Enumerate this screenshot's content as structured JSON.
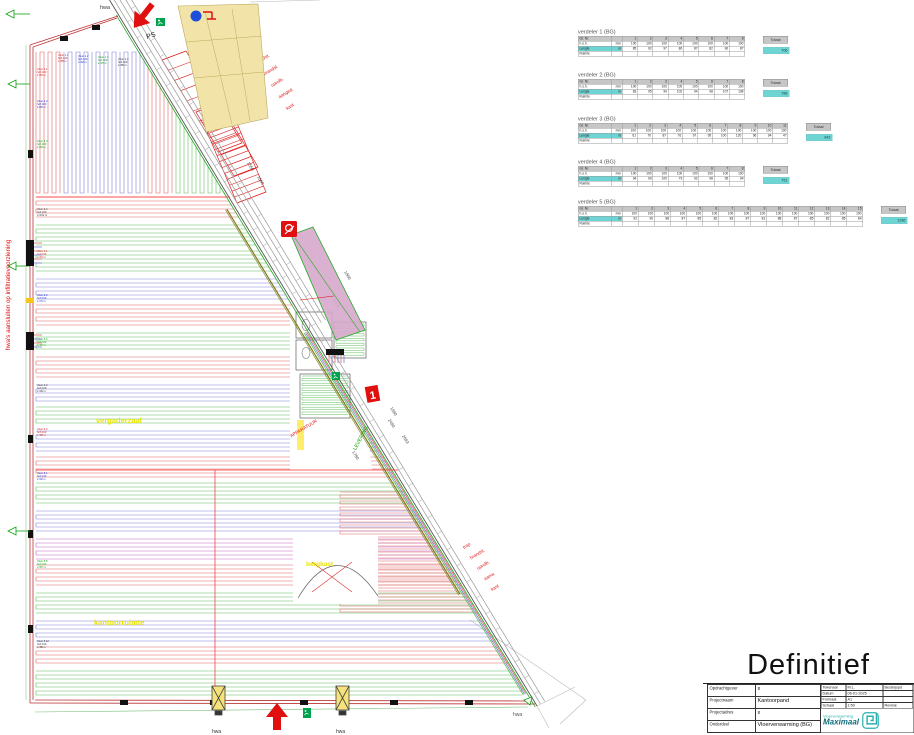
{
  "status_title": "Definitief",
  "plan": {
    "note_left": "hwa's aansluiten op infiltratievoorziening",
    "hwa": "hwa",
    "ps": "PS",
    "unit_one": "1",
    "rooms": {
      "vergaderzaal": "vergaderzaal",
      "kantoorruimte": "kantoorruimte",
      "bergkast": "bergkast",
      "apparatuur": "APPARATUUR",
      "levering": "LEVERING"
    },
    "stack_top": [
      "Vluchtr.",
      "brandsl.",
      "oprolb.",
      "aanged.",
      "kast"
    ],
    "stack_bottom": [
      "trap",
      "brandsl.",
      "oprolb.",
      "aanw.",
      "kast"
    ],
    "dims": [
      "1550",
      "1500",
      "2100",
      "1800",
      "1990",
      "2693",
      "2490",
      "1780"
    ],
    "group_labels": [
      [
        "Vloer 1.1",
        "hoh 100",
        "L=85 m"
      ],
      [
        "Vloer 1.2",
        "hoh 100",
        "L=92 m"
      ],
      [
        "Vloer 1.3",
        "hoh 100",
        "L=97 m"
      ],
      [
        "Vloer 1.4",
        "hoh 100",
        "L=86 m"
      ],
      [
        "Vloer 2.1",
        "hoh 100",
        "L=83 m"
      ],
      [
        "Vloer 2.2",
        "hoh 100",
        "L=95 m"
      ],
      [
        "Vloer 2.3",
        "hoh 100",
        "L=99 m"
      ],
      [
        "Vloer 2.4",
        "hoh 100",
        "L=102 m"
      ],
      [
        "Vloer 3.1",
        "hoh 100",
        "L=61 m"
      ],
      [
        "Vloer 3.2",
        "hoh 100",
        "L=70 m"
      ],
      [
        "Vloer 3.5",
        "hoh 100",
        "L=97 m"
      ],
      [
        "Vloer 4.2",
        "hoh 100",
        "L=99 m"
      ],
      [
        "Vloer 4.6",
        "hoh 100",
        "L=98 m"
      ],
      [
        "Vloer 5.1",
        "hoh 100",
        "L=92 m"
      ],
      [
        "Vloer 5.8",
        "hoh 100",
        "L=87 m"
      ],
      [
        "Vloer 5.12",
        "hoh 100",
        "L=85 m"
      ]
    ]
  },
  "verdeler_table": {
    "row_group": "Gr. Nr.",
    "row_hoh": "h.o.h.",
    "row_len": "Lengte",
    "row_room": "Ruimte",
    "unit_mm": "mm",
    "unit_m": "m",
    "total_label": "Totaal"
  },
  "verdelers": [
    {
      "title": "verdeler 1 (BG)",
      "hoh": "100",
      "lengths": [
        "85",
        "92",
        "97",
        "86",
        "87",
        "82",
        "90",
        "87"
      ],
      "total": "706"
    },
    {
      "title": "verdeler 2 (BG)",
      "hoh": "100",
      "lengths": [
        "83",
        "95",
        "99",
        "102",
        "94",
        "98",
        "107",
        "108"
      ],
      "total": "786"
    },
    {
      "title": "verdeler 3 (BG)",
      "hoh": "100",
      "lengths": [
        "61",
        "70",
        "87",
        "76",
        "97",
        "95",
        "100",
        "120",
        "96",
        "94",
        "47"
      ],
      "total": "943"
    },
    {
      "title": "verdeler 4 (BG)",
      "hoh": "100",
      "lengths": [
        "94",
        "99",
        "100",
        "79",
        "92",
        "98",
        "95",
        "94"
      ],
      "total": "751"
    },
    {
      "title": "verdeler 5 (BG)",
      "hoh": "100",
      "lengths": [
        "92",
        "90",
        "88",
        "87",
        "85",
        "82",
        "83",
        "87",
        "81",
        "88",
        "87",
        "85",
        "82",
        "85",
        "84"
      ],
      "total": "1286"
    }
  ],
  "titleblock": {
    "rows": [
      {
        "label": "Opdrachtgever",
        "value": "x"
      },
      {
        "label": "Projectnaam",
        "value": "Kantoorpand"
      },
      {
        "label": "Projectadres",
        "value": "x"
      },
      {
        "label": "Onderdeel",
        "value": "Vloerverwarming (BG)"
      }
    ],
    "info": [
      {
        "label": "Tekenaar",
        "value": "M.L.",
        "extra": "Besteljopd"
      },
      {
        "label": "Datum",
        "value": "06-01-2025",
        "extra": ""
      },
      {
        "label": "Formaat",
        "value": "A1",
        "extra": ""
      },
      {
        "label": "Schaal",
        "value": "1:50",
        "extra": "Revisie"
      }
    ],
    "logo": {
      "line1": "Vloerverwarming",
      "line2": "Maximaal"
    }
  },
  "colors": {
    "loop_red": "#e06666",
    "loop_green": "#5fbe5f",
    "loop_blue": "#8080d8",
    "loop_magenta": "#c864c8",
    "teal": "#6fd4d4",
    "zone_red": "#ff2a2a",
    "facade_gray": "#9a9a9a",
    "yellow_fill": "#f2e4a8",
    "purple_fill": "#d6a9cb",
    "exit_green": "#00a24d",
    "fire_red": "#e01010",
    "olive": "#7d7d20"
  }
}
